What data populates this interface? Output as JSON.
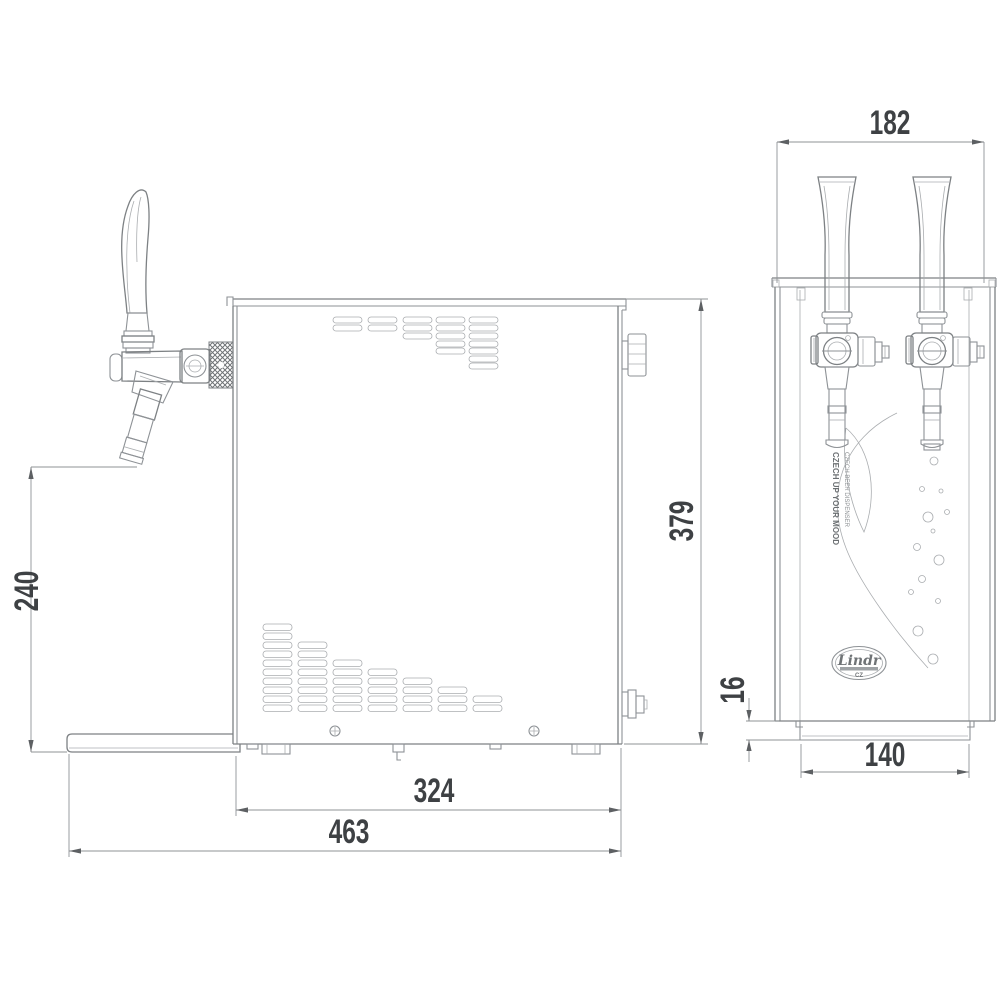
{
  "dims": {
    "d240": "240",
    "d379": "379",
    "d324": "324",
    "d463": "463",
    "d182": "182",
    "d16": "16",
    "d140": "140"
  },
  "branding": {
    "logo": "Lindr",
    "country": "CZ",
    "slogan1": "CZECH UP YOUR MOOD",
    "slogan2": "CZECH BEER DISPENSER"
  }
}
